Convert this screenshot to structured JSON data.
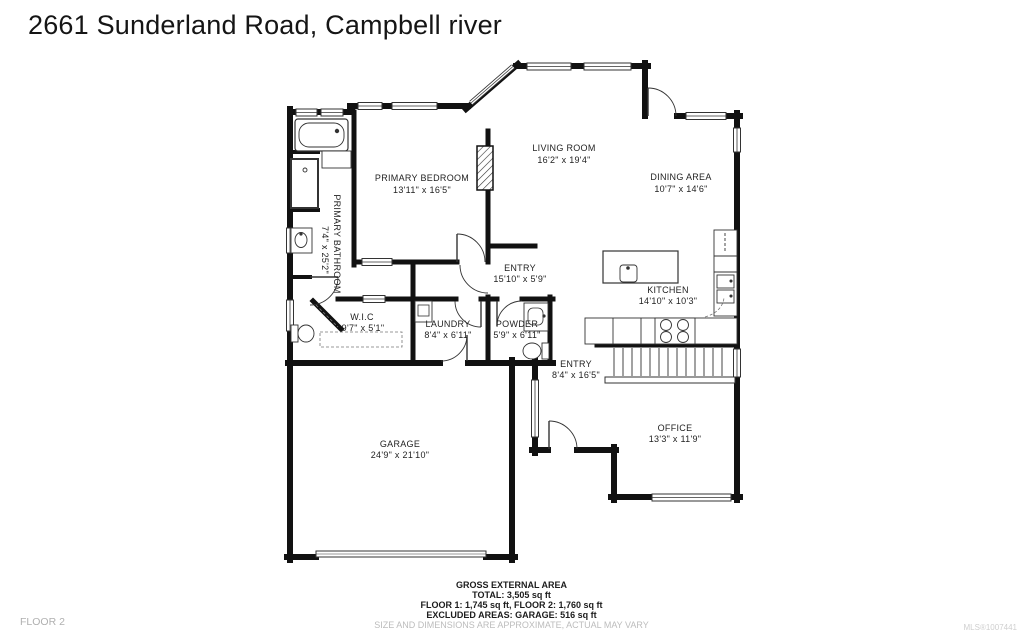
{
  "title": "2661 Sunderland Road, Campbell river",
  "floor_label": "FLOOR 2",
  "mls": "MLS®1007441",
  "colors": {
    "walls": "#111111",
    "labels": "#1f1f1f",
    "muted_text": "#bcbcbc",
    "footnote": "#cfcfcf"
  },
  "footer": {
    "line1": "GROSS EXTERNAL AREA",
    "line2": "TOTAL: 3,505 sq ft",
    "line3": "FLOOR 1: 1,745 sq ft, FLOOR 2: 1,760 sq ft",
    "line4": "EXCLUDED AREAS: GARAGE: 516 sq ft",
    "disclaimer": "SIZE AND DIMENSIONS ARE APPROXIMATE, ACTUAL MAY VARY"
  },
  "rooms": {
    "primary_bedroom": {
      "name": "PRIMARY BEDROOM",
      "dims": "13'11\" x 16'5\""
    },
    "primary_bathroom": {
      "name": "PRIMARY BATHROOM",
      "dims": "7'4\" x 25'2\""
    },
    "living_room": {
      "name": "LIVING ROOM",
      "dims": "16'2\" x 19'4\""
    },
    "dining_area": {
      "name": "DINING AREA",
      "dims": "10'7\" x 14'6\""
    },
    "entry_hall": {
      "name": "ENTRY",
      "dims": "15'10\" x 5'9\""
    },
    "kitchen": {
      "name": "KITCHEN",
      "dims": "14'10\" x 10'3\""
    },
    "wic": {
      "name": "W.I.C",
      "dims": "9'7\" x 5'1\""
    },
    "laundry": {
      "name": "LAUNDRY",
      "dims": "8'4\" x 6'11\""
    },
    "powder": {
      "name": "POWDER",
      "dims": "5'9\" x 6'11\""
    },
    "entry_front": {
      "name": "ENTRY",
      "dims": "8'4\" x 16'5\""
    },
    "garage": {
      "name": "GARAGE",
      "dims": "24'9\" x 21'10\""
    },
    "office": {
      "name": "OFFICE",
      "dims": "13'3\" x 11'9\""
    }
  }
}
